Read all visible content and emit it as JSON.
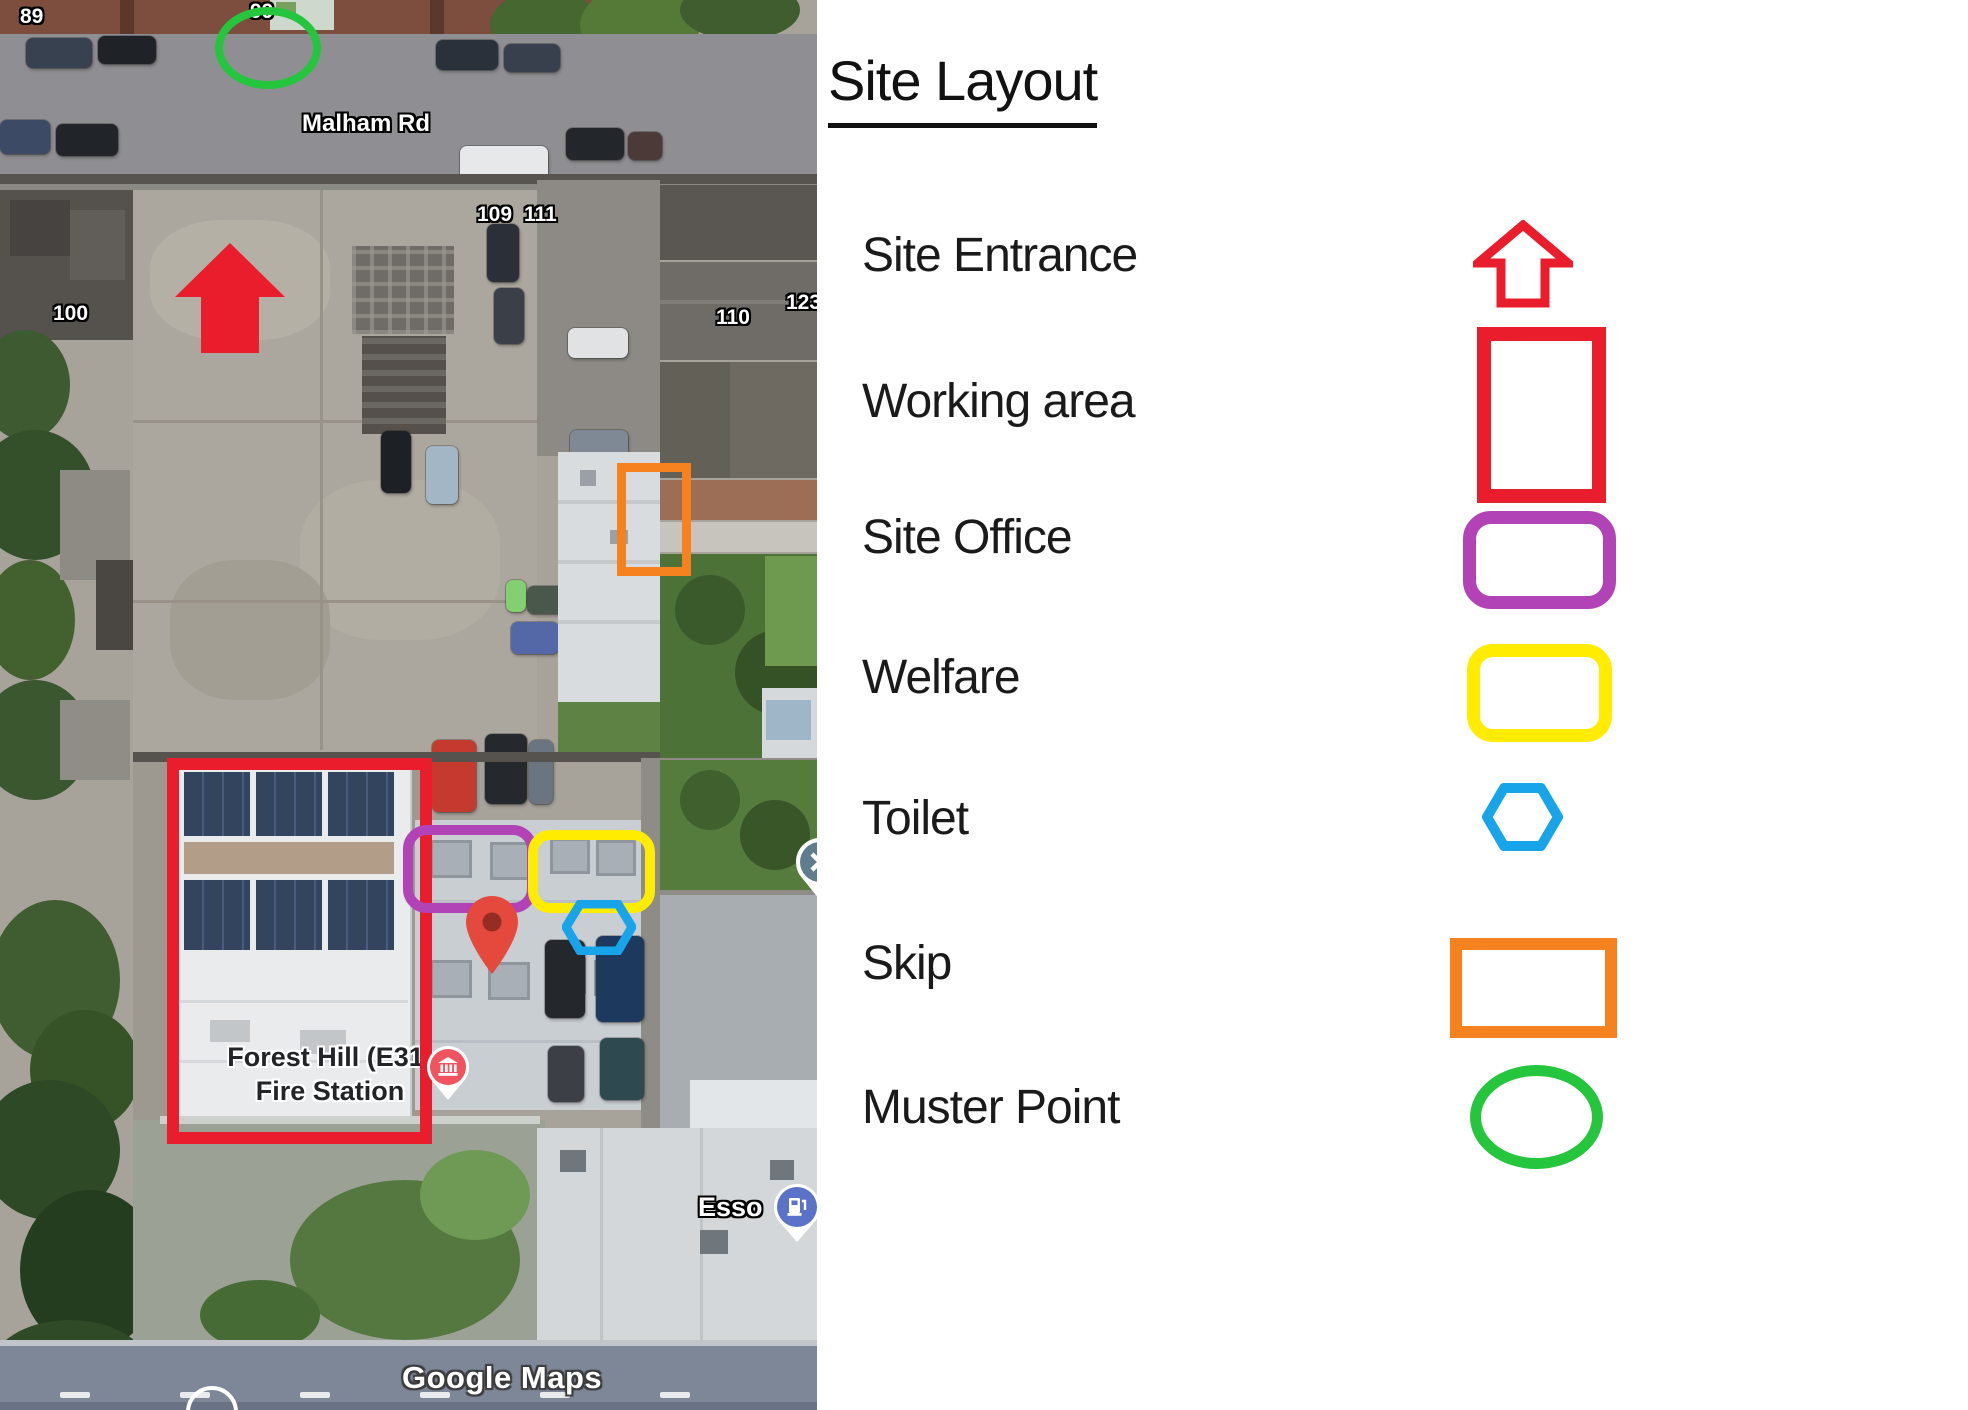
{
  "legend": {
    "title": "Site Layout",
    "items": [
      {
        "label": "Site Entrance",
        "shape": "block-arrow-up",
        "color": "red"
      },
      {
        "label": "Working area",
        "shape": "rectangle",
        "color": "red"
      },
      {
        "label": "Site Office",
        "shape": "rounded-rectangle",
        "color": "purple"
      },
      {
        "label": "Welfare",
        "shape": "rounded-rectangle",
        "color": "yellow"
      },
      {
        "label": "Toilet",
        "shape": "hexagon",
        "color": "blue"
      },
      {
        "label": "Skip",
        "shape": "rectangle",
        "color": "orange"
      },
      {
        "label": "Muster Point",
        "shape": "ellipse",
        "color": "green"
      }
    ]
  },
  "map": {
    "street_label": "Malham Rd",
    "house_numbers": {
      "n89": "89",
      "n99": "99",
      "n100": "100",
      "n109": "109",
      "n111": "111",
      "n110": "110",
      "n123": "123"
    },
    "fire_station_label": {
      "line1": "Forest Hill (E31)",
      "line2": "Fire Station"
    },
    "fuel_station_label": "Esso",
    "watermark": "Google Maps"
  },
  "colors": {
    "red": "#e91d2c",
    "purple": "#b243b6",
    "yellow": "#ffec00",
    "blue": "#17a4e9",
    "orange": "#f5821f",
    "green": "#25c53e",
    "map_pin": "#e5493d",
    "map_pin_dark": "#962d24",
    "fire_poi": "#f0545f",
    "fuel_poi": "#5a73c9",
    "closed_poi": "#5f7d8c"
  }
}
